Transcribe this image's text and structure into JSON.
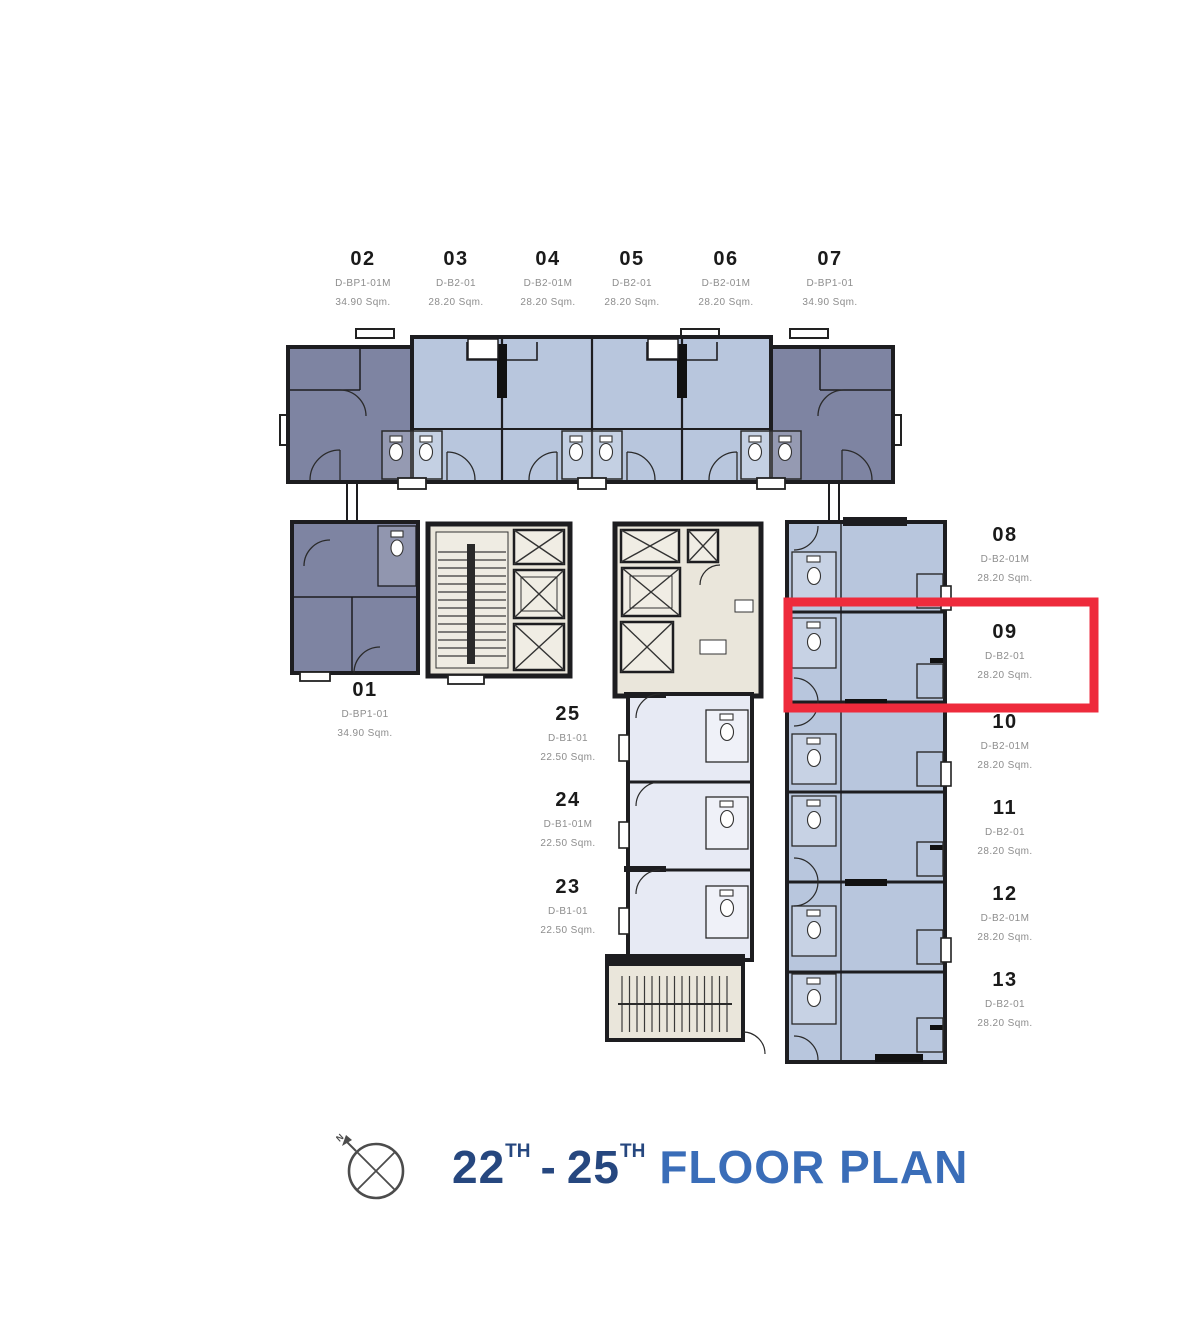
{
  "palette": {
    "highlight_red": "#ee2b3c",
    "title_number_blue": "#26477f",
    "title_text_blue": "#3a6db8",
    "unit_dark_fill": "#7e84a2",
    "unit_light_fill": "#b8c6dd",
    "unit_pale_fill": "#e7eaf4",
    "core_fill": "#eae6db",
    "wall_color": "#1d1d20",
    "label_number_color": "#1a1a1a",
    "label_sub_color": "#8d8d8d"
  },
  "title": {
    "floor_start": "22",
    "floor_start_sup": "TH",
    "separator": "-",
    "floor_end": "25",
    "floor_end_sup": "TH",
    "label": "FLOOR PLAN"
  },
  "compass": {
    "north_label": "N"
  },
  "highlight": {
    "unit": "09"
  },
  "units": {
    "top_row": [
      {
        "number": "02",
        "type": "D-BP1-01M",
        "area": "34.90 Sqm."
      },
      {
        "number": "03",
        "type": "D-B2-01",
        "area": "28.20 Sqm."
      },
      {
        "number": "04",
        "type": "D-B2-01M",
        "area": "28.20 Sqm."
      },
      {
        "number": "05",
        "type": "D-B2-01",
        "area": "28.20 Sqm."
      },
      {
        "number": "06",
        "type": "D-B2-01M",
        "area": "28.20 Sqm."
      },
      {
        "number": "07",
        "type": "D-BP1-01",
        "area": "34.90 Sqm."
      }
    ],
    "left": [
      {
        "number": "01",
        "type": "D-BP1-01",
        "area": "34.90 Sqm."
      }
    ],
    "middle_column": [
      {
        "number": "25",
        "type": "D-B1-01",
        "area": "22.50 Sqm."
      },
      {
        "number": "24",
        "type": "D-B1-01M",
        "area": "22.50 Sqm."
      },
      {
        "number": "23",
        "type": "D-B1-01",
        "area": "22.50 Sqm."
      }
    ],
    "right_column": [
      {
        "number": "08",
        "type": "D-B2-01M",
        "area": "28.20 Sqm."
      },
      {
        "number": "09",
        "type": "D-B2-01",
        "area": "28.20 Sqm."
      },
      {
        "number": "10",
        "type": "D-B2-01M",
        "area": "28.20 Sqm."
      },
      {
        "number": "11",
        "type": "D-B2-01",
        "area": "28.20 Sqm."
      },
      {
        "number": "12",
        "type": "D-B2-01M",
        "area": "28.20 Sqm."
      },
      {
        "number": "13",
        "type": "D-B2-01",
        "area": "28.20 Sqm."
      }
    ]
  }
}
